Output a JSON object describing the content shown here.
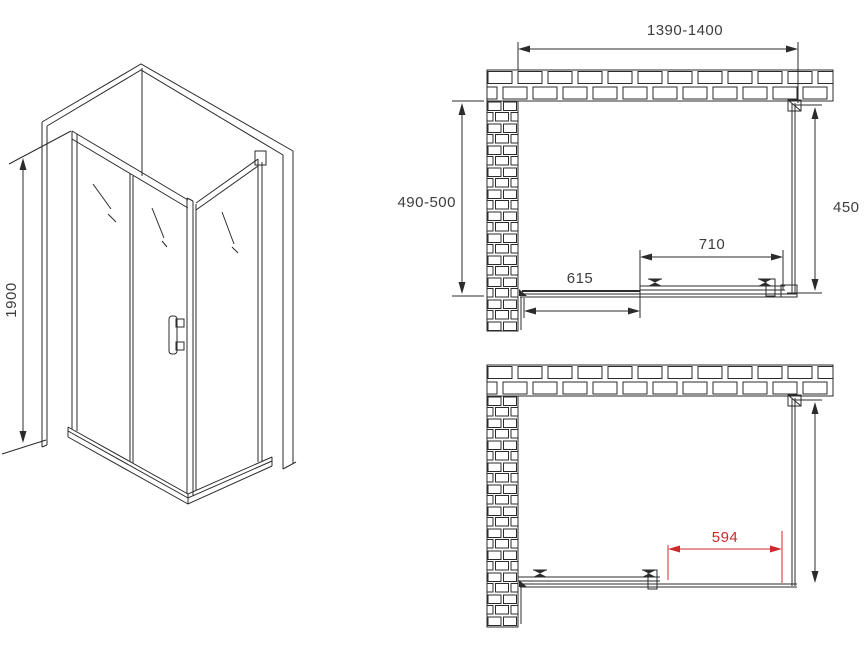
{
  "drawing": {
    "type": "shower-enclosure-installation-diagram",
    "isometric": {
      "height": "1900"
    },
    "plan_closed": {
      "width": "1390-1400",
      "depth": "490-500",
      "side_panel": "450",
      "sliding_door": "710",
      "fixed_panel": "615"
    },
    "plan_open": {
      "opening": "594"
    }
  },
  "colors": {
    "line": "#2b2b2b",
    "dim_text": "#3d3d3d",
    "highlight_red": "#cc2a2a",
    "background": "#ffffff"
  }
}
